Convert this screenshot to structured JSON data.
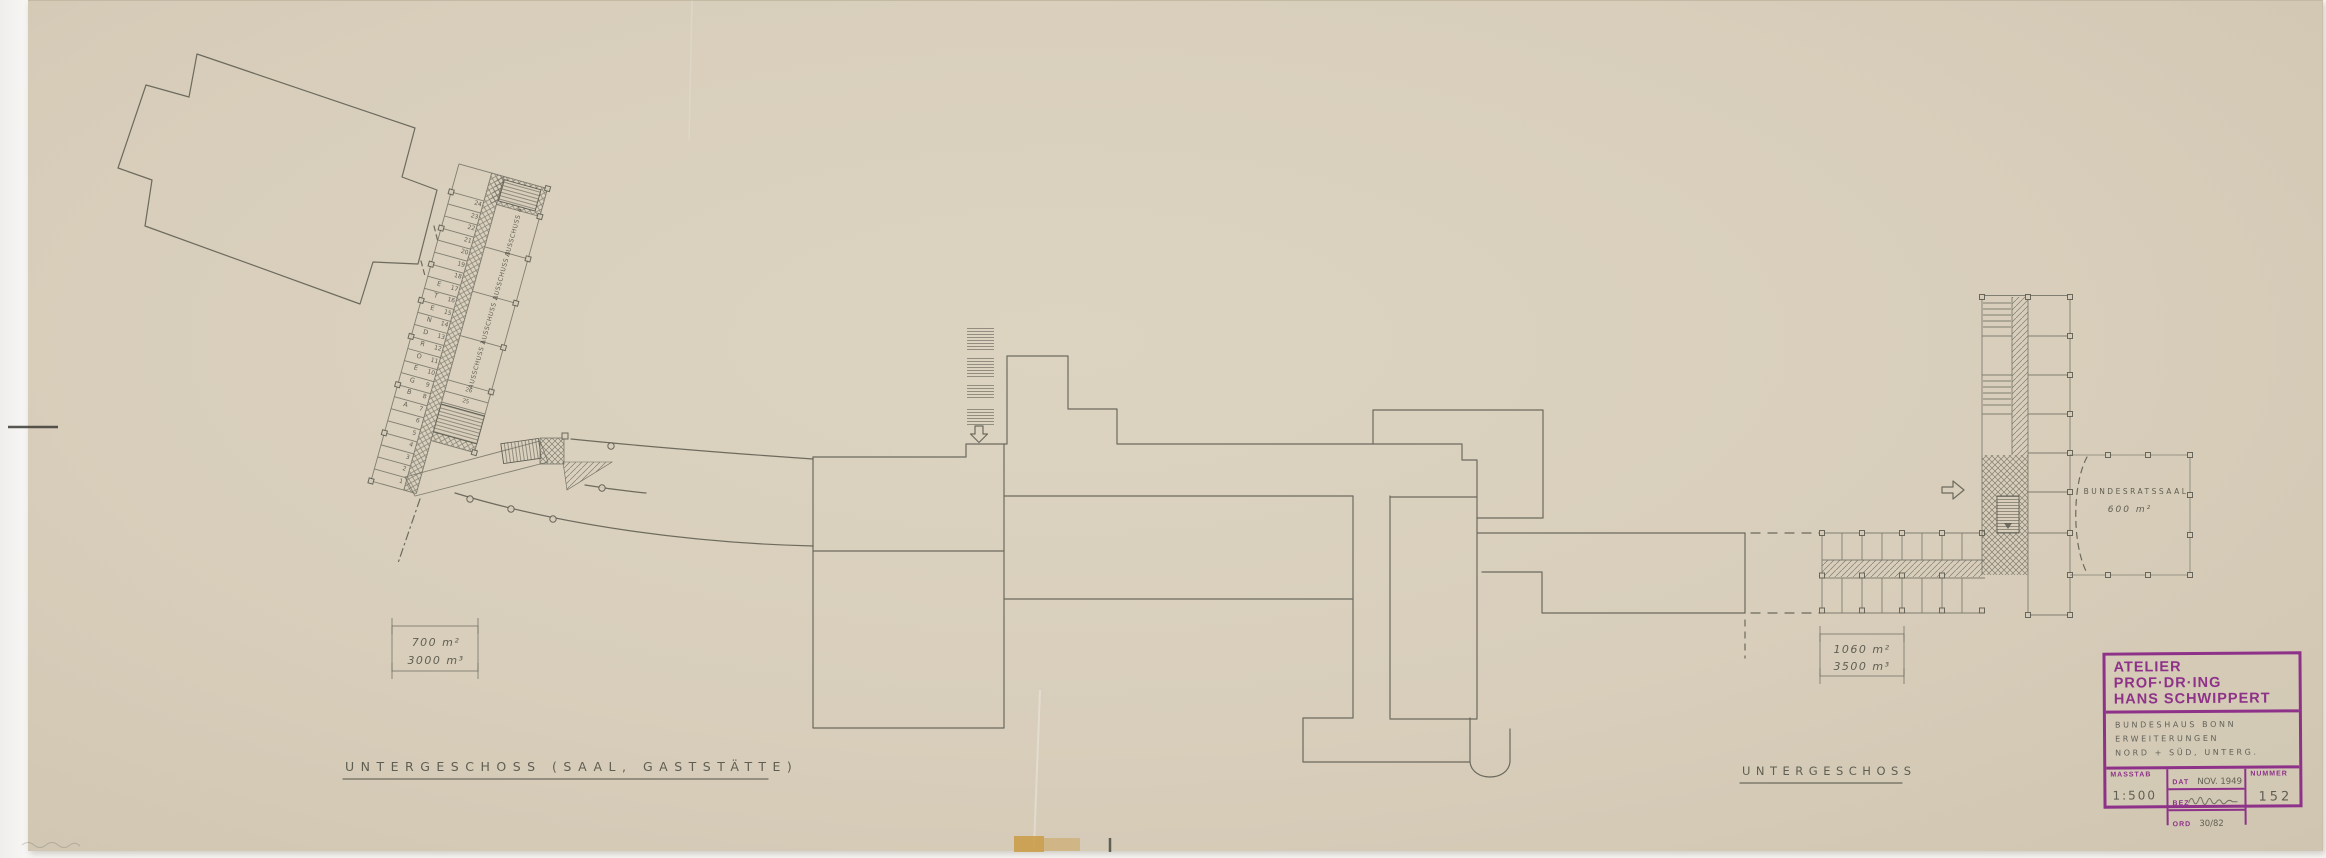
{
  "plan": {
    "labels": {
      "left": "UNTERGESCHOSS  (SAAL, GASTSTÄTTE)",
      "right": "UNTERGESCHOSS"
    },
    "area_boxes": {
      "left": {
        "line1": "700 m²",
        "line2": "3000 m³"
      },
      "right": {
        "line1": "1060 m²",
        "line2": "3500 m³"
      }
    },
    "bundesratssaal": {
      "name": "BUNDESRATSSAAL",
      "area": "600 m²"
    },
    "wing": {
      "stalls": [
        "1",
        "2",
        "3",
        "4",
        "5",
        "6",
        "7",
        "8",
        "9",
        "10",
        "11",
        "12",
        "13",
        "14",
        "15",
        "16",
        "17",
        "18",
        "19",
        "20",
        "21",
        "22",
        "23",
        "24"
      ],
      "letters": [
        "A",
        "B",
        "G",
        "E",
        "O",
        "R",
        "D",
        "N",
        "E",
        "T",
        "E"
      ],
      "annex_cells": [
        "25",
        "26"
      ],
      "rooms": [
        "AUSSCHUSS 1",
        "AUSSCHUSS 2",
        "AUSSCHUSS 3",
        "AUSSCHUSS 4"
      ]
    }
  },
  "title_block": {
    "studio_line1": "ATELIER PROF·DR·ING",
    "studio_line2": "HANS SCHWIPPERT",
    "project_line1": "BUNDESHAUS BONN",
    "project_line2": "ERWEITERUNGEN",
    "project_line3": "NORD + SÜD, UNTERG.",
    "masstab_label": "MASSTAB",
    "masstab_value": "1:500",
    "dat_label": "DAT",
    "dat_value": "NOV. 1949",
    "bez_label": "BEZ",
    "ord_label": "ORD",
    "ord_value": "30/82",
    "nummer_label": "NUMMER",
    "nummer_value": "152"
  },
  "colors": {
    "paper": "#d8cebb",
    "pencil": "#5d5c51",
    "stamp_ink": "#8e3189",
    "tape_stain": "#c9973f"
  }
}
